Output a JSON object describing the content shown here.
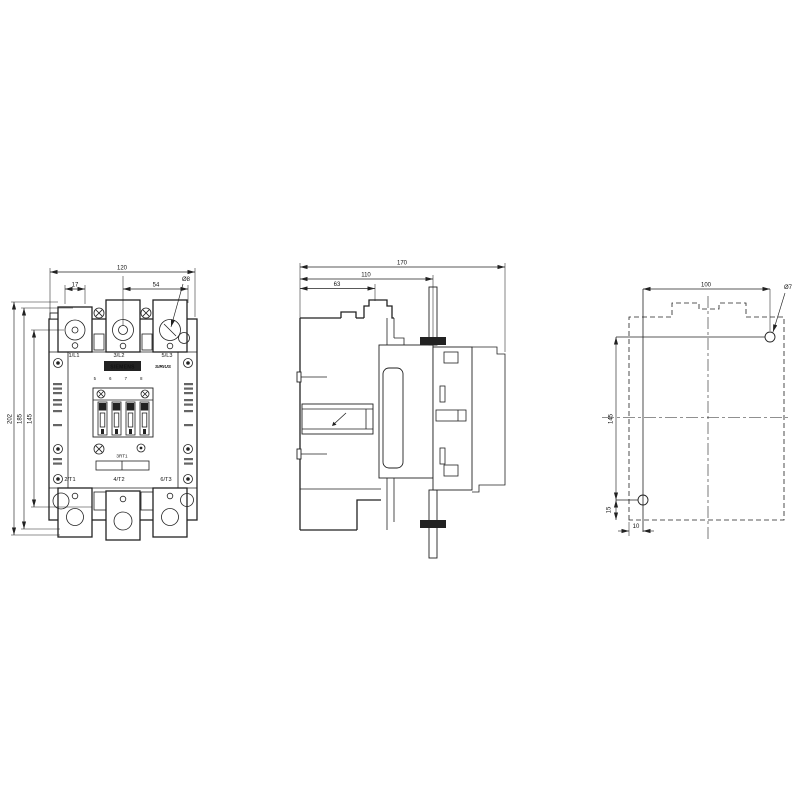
{
  "page": {
    "title": "Contactor dimensional drawing",
    "background": "#ffffff",
    "line_color": "#222222"
  },
  "brand_plate": {
    "brand": "SIEMENS",
    "series": "SIRIUS",
    "model": "3RT1",
    "pole_numbers": "5 6 7 8"
  },
  "front": {
    "terminals_top": [
      "1/L1",
      "3/L2",
      "5/L3"
    ],
    "terminals_bottom": [
      "2/T1",
      "4/T2",
      "6/T3"
    ],
    "dims": {
      "overall_width": "120",
      "offset_left": "17",
      "offset_mid": "54",
      "terminal_hole": "Ø8",
      "overall_height": "202",
      "height_inner": "185",
      "mount_spacing_v": "145"
    }
  },
  "side": {
    "dims": {
      "depth_total": "170",
      "depth_mid": "110",
      "depth_front": "63"
    }
  },
  "rear": {
    "dims": {
      "mount_spacing_h": "100",
      "mount_hole": "Ø7",
      "mount_spacing_v": "145",
      "edge_offset_v": "15",
      "edge_offset_h": "10"
    }
  }
}
